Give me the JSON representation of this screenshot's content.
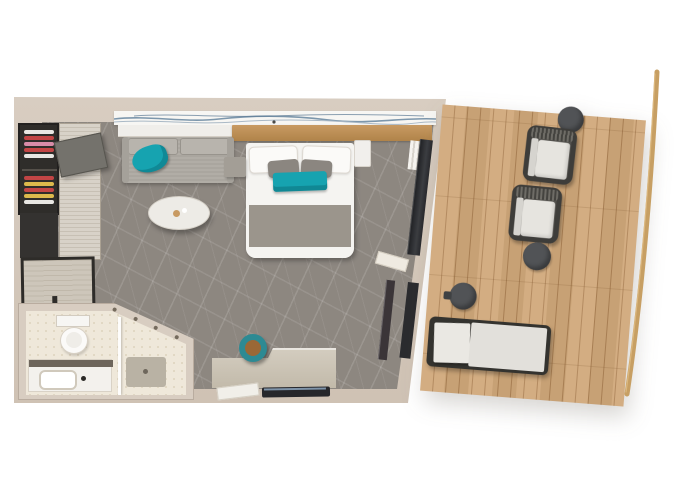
{
  "floorplan": {
    "type": "cruise-ship-balcony-stateroom",
    "areas": [
      {
        "name": "stateroom",
        "furniture": [
          "wardrobe-shelves-with-clothes",
          "wardrobe-sliding-doors",
          "minibar-cabinet",
          "sofa-with-teal-throw",
          "coffee-table",
          "double-bed",
          "white-pillows",
          "gray-pillows",
          "teal-bed-runner",
          "nightstand-left",
          "nightstand-right",
          "headboard-wood-shelf",
          "wall-art-wave-print",
          "desk",
          "round-stool",
          "tv",
          "sliding-glass-balcony-door",
          "curtain",
          "leaning-mirror"
        ]
      },
      {
        "name": "bathroom",
        "furniture": [
          "toilet",
          "vanity-with-sink",
          "shower",
          "shower-controls",
          "glass-divider",
          "shower-mat"
        ]
      },
      {
        "name": "balcony",
        "furniture": [
          "armchair",
          "armchair",
          "side-table",
          "side-table",
          "side-table",
          "sun-lounger",
          "ship-railing"
        ]
      }
    ],
    "palette": {
      "wall": "#d8cdc1",
      "wall_shade": "#cfc2b4",
      "carpet": "#8d8780",
      "deck_wood": "#d0a87a",
      "deck_line": "#a8784b",
      "railing_wood": "#c79f63",
      "bed_white": "#f5f4f1",
      "bed_runner": "#9b958c",
      "pillow_gray": "#8b8680",
      "teal_accent": "#16a3b0",
      "teal_dark": "#2d8a93",
      "sofa_gray": "#aaa69f",
      "coffee_table": "#edebe6",
      "desk_wood": "#cdc6b8",
      "stool_leather": "#9a6836",
      "bath_floor": "#efe8da",
      "shower_mat": "#b9b2a4",
      "fixture_white": "#f7f6f3",
      "closet_dark": "#2f2d2a",
      "clothes_red": "#c24545",
      "clothes_yellow": "#dcb94c",
      "clothes_pink": "#d88ca8",
      "chair_frame": "#3e3d3a",
      "chair_cushion": "#e6e4df",
      "side_table": "#515356",
      "glass_dark": "#26272b",
      "wood_shelf": "#c89a62",
      "art_white": "#f7f6f3",
      "art_wave_blue": "#7d97ac"
    }
  }
}
